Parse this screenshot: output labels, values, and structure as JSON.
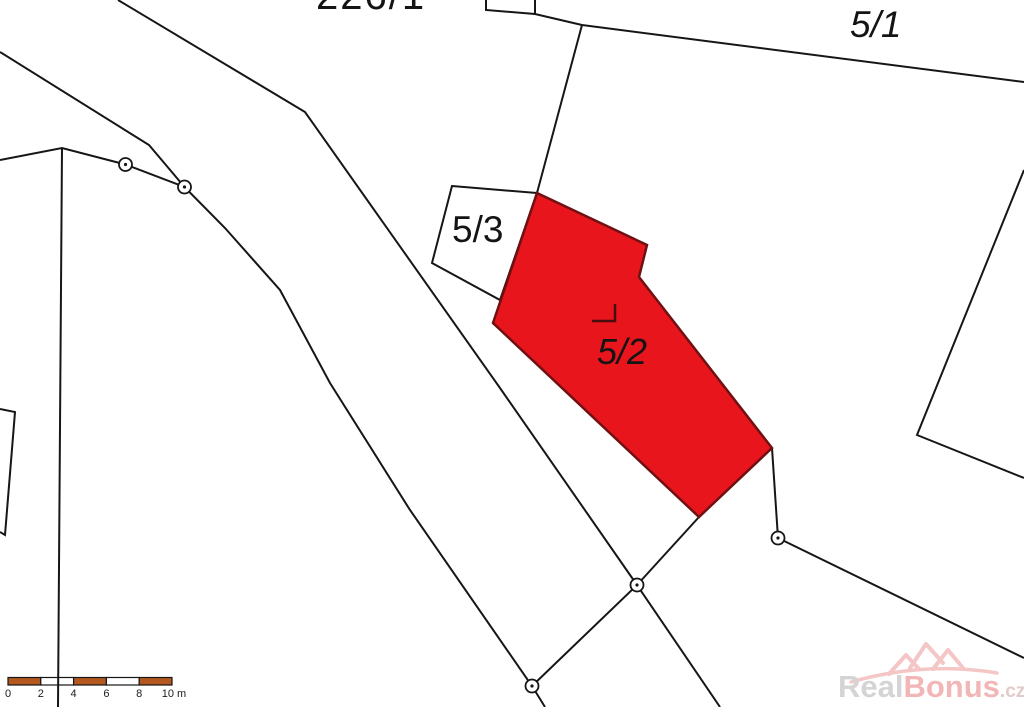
{
  "canvas": {
    "width": 1024,
    "height": 707
  },
  "parcels": {
    "road_parcel": {
      "label": "226/1"
    },
    "parcel_5_1": {
      "label": "5/1"
    },
    "parcel_5_3": {
      "label": "5/3"
    },
    "parcel_5_2": {
      "label": "5/2",
      "status": "highlighted"
    }
  },
  "scalebar": {
    "ticks": [
      "0",
      "2",
      "4",
      "6",
      "8",
      "10 m"
    ]
  },
  "watermark": {
    "text_primary": "Real",
    "text_accent": "Bonus",
    "text_suffix": ".cz"
  },
  "colors": {
    "highlight_fill": "#e8151c",
    "highlight_border": "#701012",
    "building_mark": "#4a0d0d",
    "map_line": "#161616",
    "scale_orange": "#b3591f",
    "scale_white": "#ffffff",
    "watermark_logo": "#f4c6c6"
  }
}
